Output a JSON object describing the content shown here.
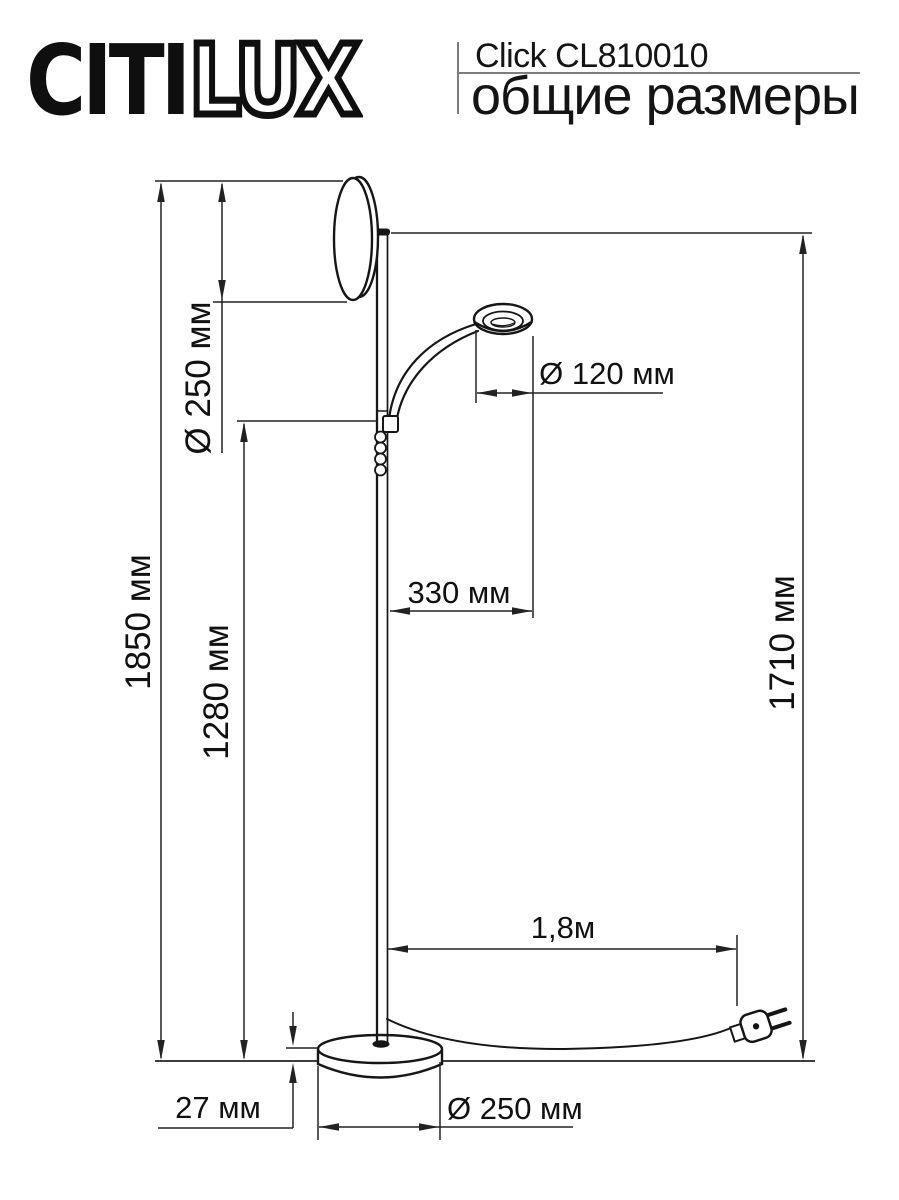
{
  "header": {
    "brand_solid": "CITI",
    "brand_outline": "LUX",
    "product_title": "Click CL810010",
    "page_subtitle": "общие размеры"
  },
  "dimensions": {
    "overall_height": "1850 мм",
    "shade_diameter": "Ø 250 мм",
    "switch_height": "1280 мм",
    "pole_height": "1710 мм",
    "reader_diameter": "Ø 120 мм",
    "arm_offset": "330 мм",
    "cord_length": "1,8м",
    "base_height": "27 мм",
    "base_diameter": "Ø 250 мм"
  },
  "colors": {
    "ink": "#161616",
    "dimension_line": "#222222",
    "background": "#ffffff",
    "header_rule": "#7d7d7d"
  }
}
